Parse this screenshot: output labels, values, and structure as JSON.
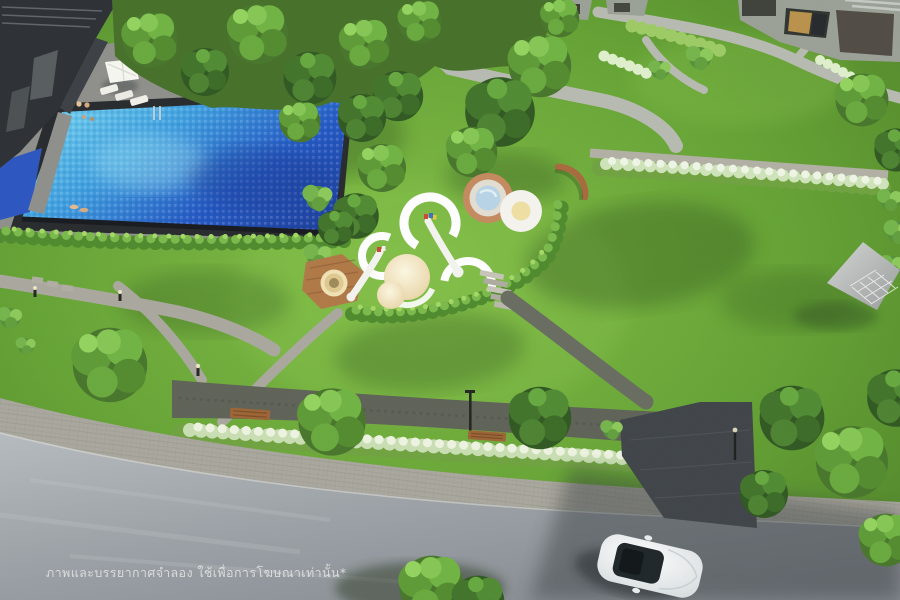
{
  "watermark": {
    "text": "ภาพและบรรยากาศจำลอง ใช้เพื่อการโฆษณาเท่านั้น*"
  },
  "scene": {
    "kind": "aerial 3D rendering of a condominium landscape",
    "features": [
      "dark residential building with swimming pool and sun deck",
      "white umbrella and pool loungers",
      "central lawn with circular playground rings and climbing domes",
      "splash pad circles and wooden play deck",
      "hedge-lined garden paths with bollard lights",
      "lattice-roof pavilion",
      "tree-lined gravel walkway with wooden benches",
      "white flowering shrub bands",
      "paver sidewalk and asphalt road",
      "white car driving on road",
      "villas with glowing windows"
    ]
  },
  "colors": {
    "lawn": "#6fb039",
    "building": "#2b2f33",
    "deck": "#8e8f8a",
    "deck_dark": "#26292c",
    "pool_shallow": "#66cdef",
    "pool_deep": "#1d3fa8",
    "path": "#b2b0a4",
    "walkway": "#5e6156",
    "sidewalk": "#a9a79d",
    "plaza": "#3e4347",
    "road": "#9ba1a6",
    "wood": "#b07845",
    "bench": "#9c6434",
    "cream": "#f0e2b4",
    "copper": "#c4895e",
    "splash_blue": "#b8d4e6",
    "ring_white": "#ffffff",
    "car_body": "#f4f7f6",
    "car_glass": "#1d2427",
    "watermark": "#e9e9e9"
  }
}
